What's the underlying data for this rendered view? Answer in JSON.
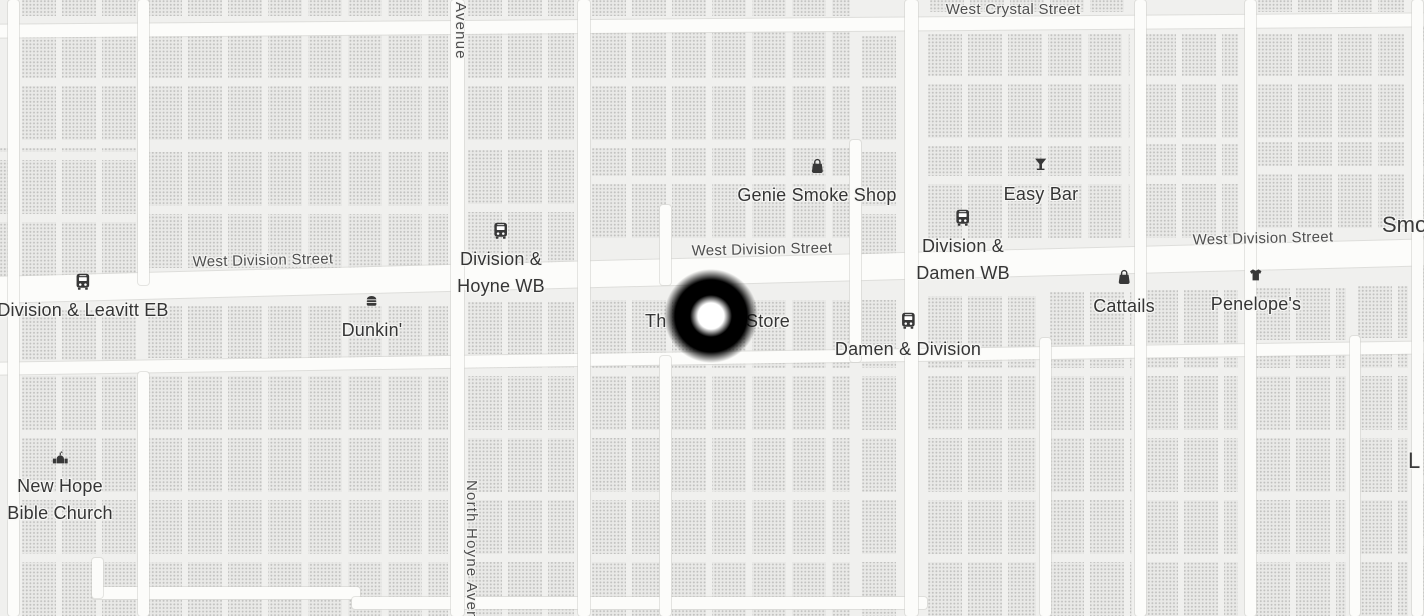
{
  "colors": {
    "background": "#f0f0ee",
    "building": "#e9e9e7",
    "road": "#fcfcfa",
    "poi_label": "#353535",
    "street_label": "#4f4f4f",
    "marker_outer": "#000000",
    "marker_inner": "#ffffff"
  },
  "streets": {
    "crystal": {
      "label": "West Crystal Street"
    },
    "division_left": {
      "label": "West Division Street"
    },
    "division_center": {
      "label": "West Division Street"
    },
    "division_right": {
      "label": "West Division Street"
    },
    "avenue_vertical_top": {
      "label": "Avenue"
    },
    "hoyne_vertical_bottom": {
      "label": "North Hoyne Avenue"
    }
  },
  "transit_stops": {
    "division_hoyne_wb": {
      "label": "Division &\nHoyne WB",
      "icon": "bus"
    },
    "division_damen_wb": {
      "label": "Division &\nDamen WB",
      "icon": "bus"
    },
    "damen_division": {
      "label": "Damen & Division",
      "icon": "bus"
    },
    "division_leavitt_eb": {
      "label": "Division & Leavitt EB",
      "icon": "bus"
    }
  },
  "pois": {
    "genie_smoke_shop": {
      "label": "Genie Smoke Shop",
      "icon": "shopping-bag"
    },
    "easy_bar": {
      "label": "Easy Bar",
      "icon": "cocktail"
    },
    "dunkin": {
      "label": "Dunkin'",
      "icon": "fast-food"
    },
    "cattails": {
      "label": "Cattails",
      "icon": "shopping-bag"
    },
    "penelopes": {
      "label": "Penelope's",
      "icon": "clothing"
    },
    "new_hope_bible_church": {
      "label": "New Hope\nBible Church",
      "icon": "church"
    },
    "obscured_store": {
      "label_left": "Th",
      "label_right": "Store"
    },
    "edge_label_top_right": {
      "label": "Smo"
    },
    "edge_label_mid_right": {
      "label": "L"
    }
  },
  "marker": {
    "type": "location-marker",
    "outer_color": "#000000",
    "inner_color": "#ffffff"
  }
}
